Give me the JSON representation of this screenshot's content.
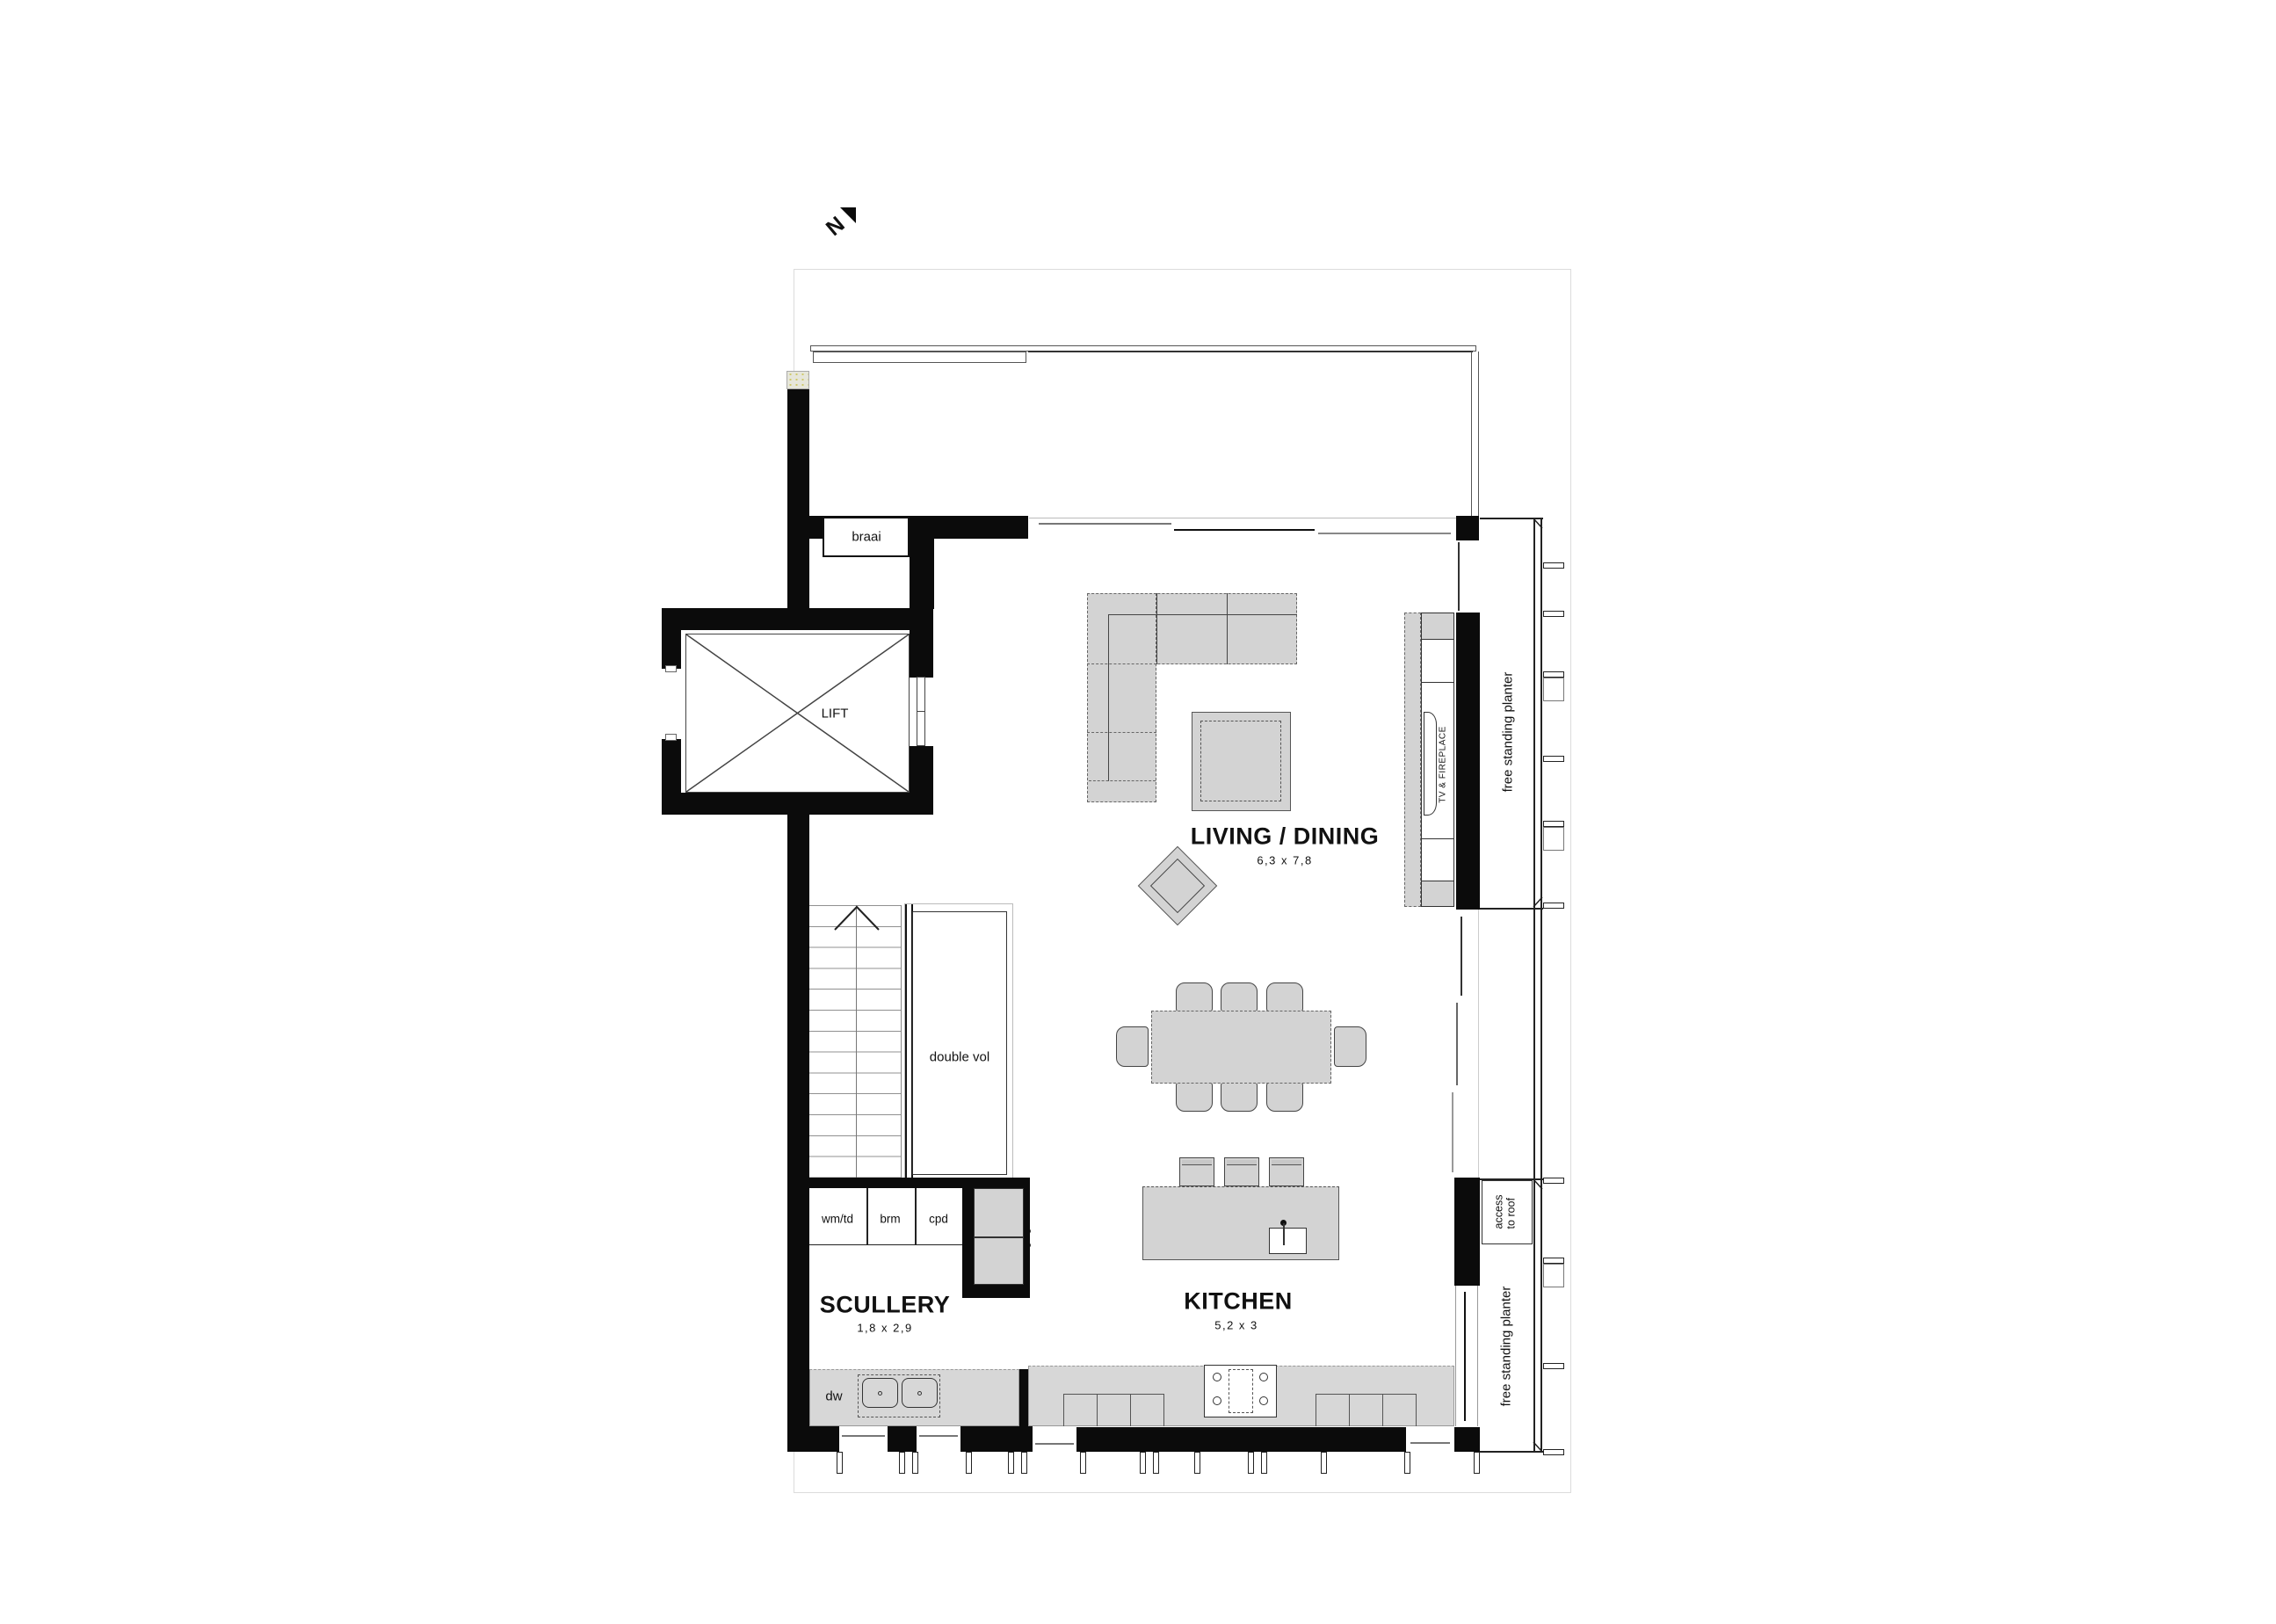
{
  "title": "first floor plan",
  "north_label": "N",
  "rooms": {
    "living": {
      "name": "LIVING / DINING",
      "dims": "6,3 x 7,8"
    },
    "kitchen": {
      "name": "KITCHEN",
      "dims": "5,2 x 3"
    },
    "scullery": {
      "name": "SCULLERY",
      "dims": "1,8 x 2,9"
    },
    "lift": {
      "name": "LIFT"
    },
    "braai": {
      "name": "braai"
    },
    "double_vol": {
      "name": "double vol"
    }
  },
  "cabinets": {
    "wm_td": "wm/td",
    "brm": "brm",
    "cpd": "cpd",
    "dw": "dw"
  },
  "annotations": {
    "tv_fireplace": "TV & FIREPLACE",
    "planter_top": "free standing planter",
    "planter_bottom": "free standing planter",
    "access_line1": "access",
    "access_line2": "to roof"
  },
  "colors": {
    "wall": "#0b0b0b",
    "furn": "#d3d3d3",
    "counter": "#d7d7d7",
    "line": "#444444"
  }
}
